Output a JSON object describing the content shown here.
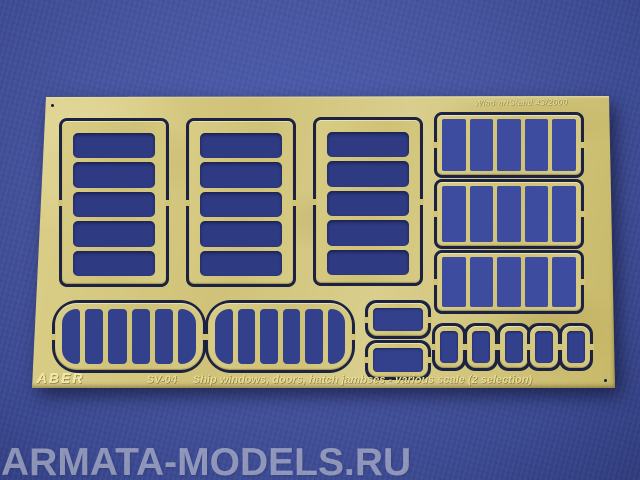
{
  "image_type": "product photograph of a photo-etched brass fret on a blue textured background",
  "background": {
    "color": "#46549f"
  },
  "sheet": {
    "etched_serial": "Wlad-artStand 43/2000",
    "brand": "ABER",
    "catalog_number": "SV-04",
    "description": "Ship windows, doors, hatch jambses - various scale (2 selection)",
    "colors": {
      "brass": "#d3c67c",
      "cut_gap": "#1c2342",
      "etched_text": "#eade96"
    },
    "parts": {
      "large_window_frames": {
        "count": 3,
        "panes_each": 5
      },
      "barred_grid_frames": {
        "count": 3,
        "columns_each": 5
      },
      "rounded_multipane_frames": {
        "count": 2,
        "panes_each": 6
      },
      "small_stacked_frames": {
        "count": 2
      },
      "small_single_frames": {
        "count": 5
      }
    }
  },
  "watermark": "ARMATA-MODELS.RU"
}
